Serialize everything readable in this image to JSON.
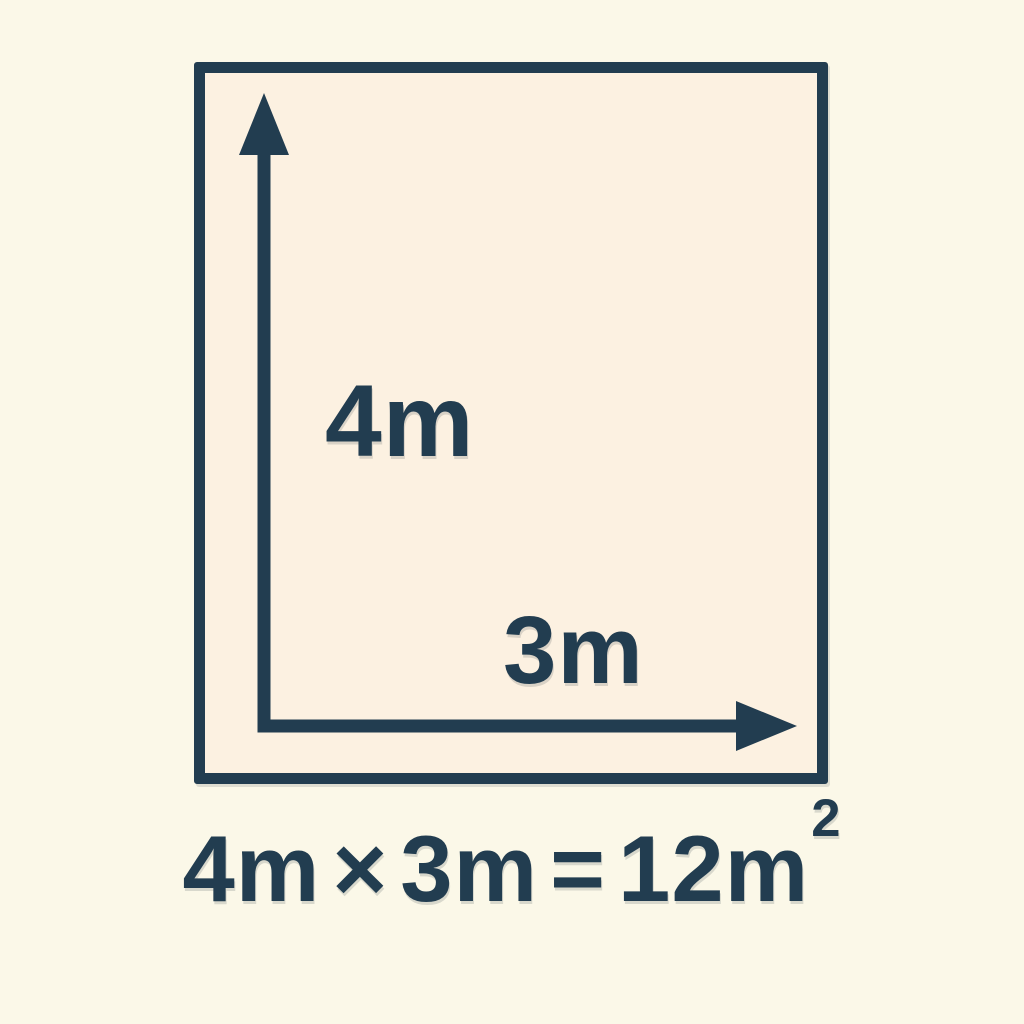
{
  "colors": {
    "background": "#FBF8E8",
    "shape_fill": "#FCF1E1",
    "ink": "#223D50"
  },
  "diagram": {
    "shape": "rectangle",
    "height_label": "4m",
    "width_label": "3m"
  },
  "formula": {
    "height_term": "4m",
    "times": "×",
    "width_term": "3m",
    "equals": "=",
    "result_base": "12m",
    "result_exponent": "2"
  }
}
